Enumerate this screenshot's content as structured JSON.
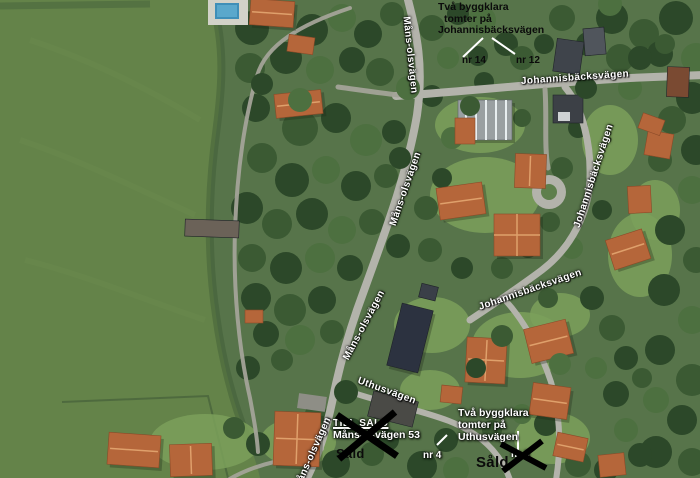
{
  "street_labels": {
    "johannisbacksvagen_top": "Johannisbäcksvägen",
    "johannisbacksvagen_right": "Johannisbäcksvägen",
    "johannisbacksvagen_mid": "Johannisbäcksvägen",
    "mansolsvagen_upper": "Måns-olsvägen",
    "mansolsvagen_mid": "Måns-olsvägen",
    "mansolsvagen_lower": "Måns-olsvägen",
    "mansolsvagen_bottom": "Måns-olsvägen",
    "uthusvagen": "Uthusvägen"
  },
  "annotations": {
    "johannisbacksvagen_note": {
      "lines": [
        "Två byggklara",
        "tomter på",
        "Johannisbäcksvägen"
      ]
    },
    "uthusvagen_note": {
      "lines": [
        "Två byggklara",
        "tomter på",
        "Uthusvägen"
      ]
    },
    "lot_nr14": "nr 14",
    "lot_nr12": "nr 12",
    "lot_nr4": "nr 4",
    "lot_nr6": "nr 6",
    "for_sale": "TILL SALU",
    "for_sale_address": "Månsolsvägen 53",
    "sold_left": "Såld",
    "sold_right": "Såld"
  },
  "colors": {
    "field_green": "#648349",
    "forest_green": "#2c4829",
    "road_gray": "#b3b3ab",
    "roof_orange": "#b5663a",
    "pool_blue": "#3f8fb8",
    "annotation_black": "#0b0b0b",
    "label_white": "#ffffff"
  }
}
